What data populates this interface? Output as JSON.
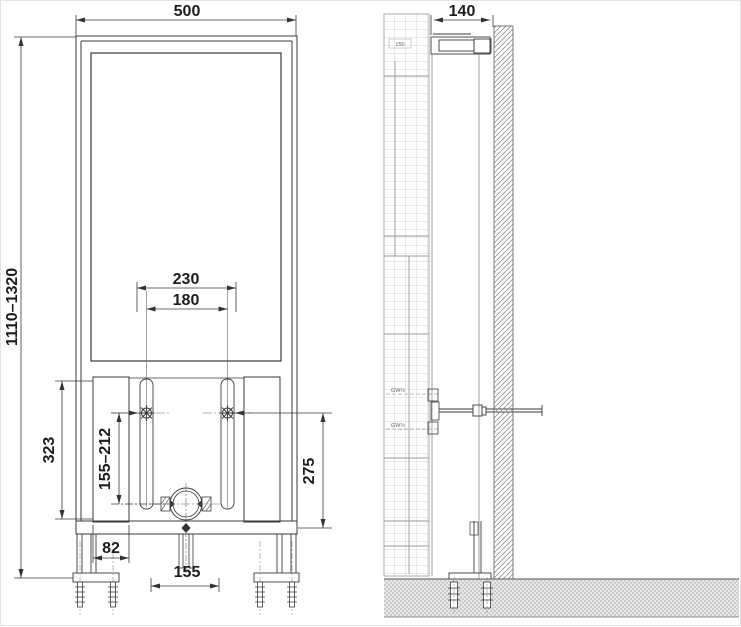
{
  "drawing": {
    "front_view": {
      "dim_overall_width": "500",
      "dim_installation_height": "1110–1320",
      "dim_fixing_spacing_outer": "230",
      "dim_fixing_spacing_inner": "180",
      "dim_lower_frame_height": "323",
      "dim_fixing_to_outlet": "155–212",
      "dim_outlet_center_height": "275",
      "dim_foot_bracket_width": "82",
      "dim_outlet_opening_width": "155"
    },
    "side_view": {
      "dim_frame_depth": "140",
      "label_top_unit": "150",
      "label_thread_upper": "GW½",
      "label_thread_lower": "GW½"
    }
  }
}
